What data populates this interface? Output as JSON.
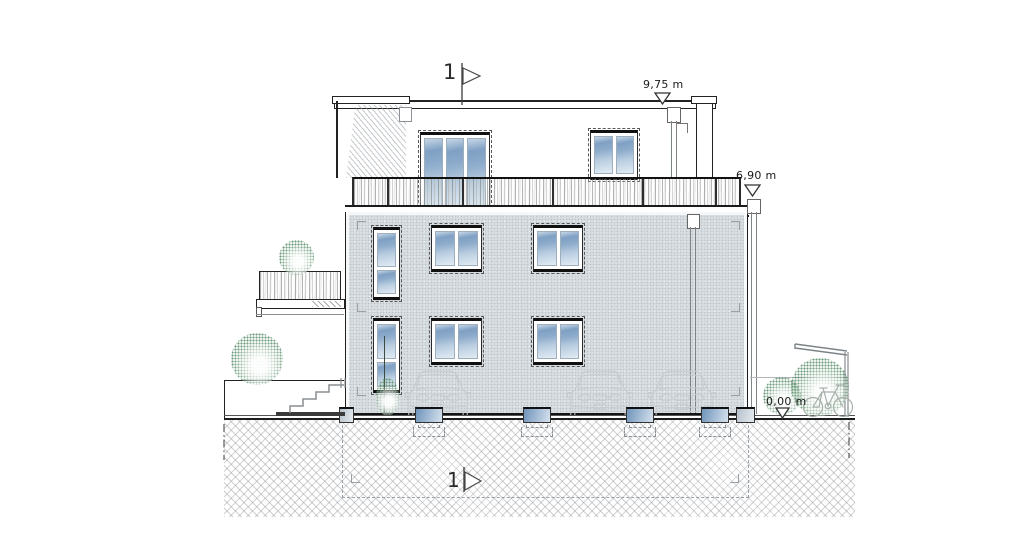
{
  "document": {
    "type": "architectural elevation drawing",
    "section_markers": {
      "top": "1",
      "bottom": "1"
    },
    "level_annotations": [
      {
        "id": "roof-parapet",
        "label": "9,75 m"
      },
      {
        "id": "terrace-floor",
        "label": "6,90 m"
      },
      {
        "id": "ground-level",
        "label": "0,00 m"
      }
    ]
  },
  "scene": {
    "ghost_cars": 3,
    "bicycles": 1,
    "bushes": 5,
    "facade_windows": 6,
    "penthouse_windows": 2,
    "foundation_footings": 4
  },
  "icons": {
    "section_flag": "right-pointing-flag-icon",
    "level_marker": "open-triangle-down-icon"
  },
  "colors": {
    "line": "#1c1c1c",
    "grayline": "#8b9196",
    "dash": "#9aa0a5",
    "facade": "#d8dde1",
    "glassDark": "#7fa0c4",
    "glassLight": "#e2ecf4",
    "ghost": "#c6cbd0",
    "bush": "#558a66",
    "hatch": "#878d93"
  }
}
